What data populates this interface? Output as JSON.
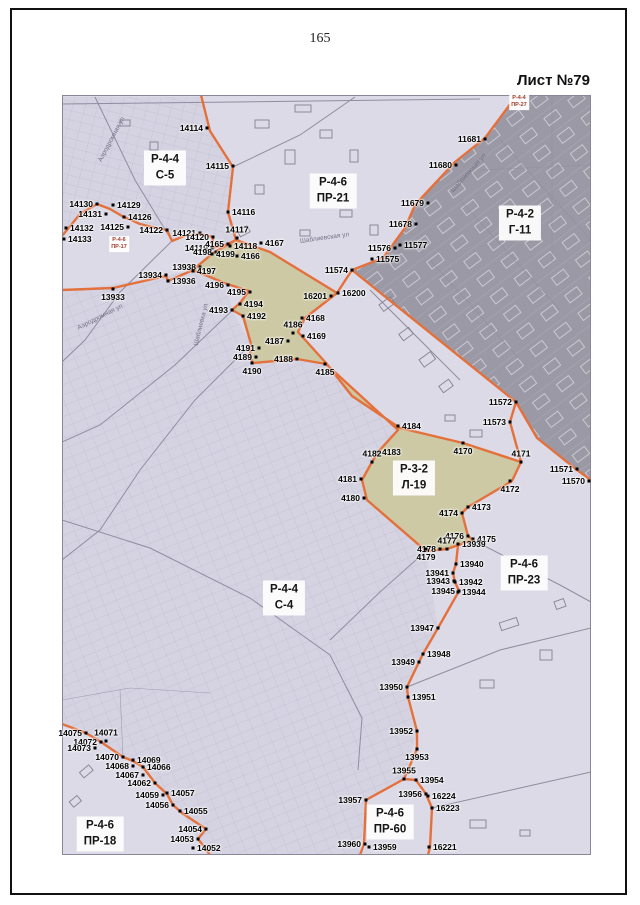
{
  "page": {
    "number": "165",
    "sheet_label": "Лист №79"
  },
  "colors": {
    "boundary": "#e4703c",
    "map_bg": "#dcdae6",
    "dark_zone": "#9b99a5",
    "khaki_zone": "#cdc9a4",
    "street": "#8f8da0"
  },
  "map": {
    "zones": [
      {
        "code": "Р-4-4",
        "name": "С-5",
        "x": 165,
        "y": 168
      },
      {
        "code": "Р-4-6",
        "name": "ПР-21",
        "x": 333,
        "y": 191
      },
      {
        "code": "Р-4-2",
        "name": "Г-11",
        "x": 520,
        "y": 223
      },
      {
        "code": "Р-3-2",
        "name": "Л-19",
        "x": 414,
        "y": 478
      },
      {
        "code": "Р-4-4",
        "name": "С-4",
        "x": 284,
        "y": 598
      },
      {
        "code": "Р-4-6",
        "name": "ПР-23",
        "x": 524,
        "y": 573
      },
      {
        "code": "Р-4-6",
        "name": "ПР-18",
        "x": 100,
        "y": 834
      },
      {
        "code": "Р-4-6",
        "name": "ПР-60",
        "x": 390,
        "y": 822
      }
    ],
    "mini_zones": [
      {
        "code": "Р-4-6",
        "name": "ПР-17",
        "x": 119,
        "y": 244
      },
      {
        "code": "Р-4-4",
        "name": "ПР-27",
        "x": 519,
        "y": 102
      }
    ],
    "street_names": [
      {
        "label": "Аэродромная ул",
        "x": 100,
        "y": 158,
        "rot": -62
      },
      {
        "label": "Аэродромная ул",
        "x": 78,
        "y": 325,
        "rot": -27
      },
      {
        "label": "Шаблиевская ул",
        "x": 300,
        "y": 238,
        "rot": -8
      },
      {
        "label": "Шаблиевская ул",
        "x": 452,
        "y": 188,
        "rot": -48
      },
      {
        "label": "Шаблиевка ул",
        "x": 196,
        "y": 342,
        "rot": -76
      }
    ],
    "points": [
      {
        "label": "14114",
        "x": 207,
        "y": 128,
        "side": "l"
      },
      {
        "label": "14115",
        "x": 233,
        "y": 166,
        "side": "l"
      },
      {
        "label": "14116",
        "x": 228,
        "y": 212,
        "side": "r"
      },
      {
        "label": "14130",
        "x": 97,
        "y": 204,
        "side": "l"
      },
      {
        "label": "14129",
        "x": 113,
        "y": 205,
        "side": "r"
      },
      {
        "label": "14131",
        "x": 106,
        "y": 214,
        "side": "l"
      },
      {
        "label": "14126",
        "x": 124,
        "y": 217,
        "side": "r"
      },
      {
        "label": "14132",
        "x": 66,
        "y": 228,
        "side": "r"
      },
      {
        "label": "14133",
        "x": 64,
        "y": 239,
        "side": "r"
      },
      {
        "label": "14125",
        "x": 128,
        "y": 227,
        "side": "l"
      },
      {
        "label": "14122",
        "x": 167,
        "y": 230,
        "side": "l"
      },
      {
        "label": "14121",
        "x": 200,
        "y": 233,
        "side": "l"
      },
      {
        "label": "14120",
        "x": 213,
        "y": 237,
        "side": "l"
      },
      {
        "label": "14119",
        "x": 212,
        "y": 248,
        "side": "l"
      },
      {
        "label": "4165",
        "x": 228,
        "y": 244,
        "side": "l"
      },
      {
        "label": "14117",
        "x": 237,
        "y": 238,
        "side": "t"
      },
      {
        "label": "14118",
        "x": 230,
        "y": 246,
        "side": "r"
      },
      {
        "label": "4167",
        "x": 261,
        "y": 243,
        "side": "r"
      },
      {
        "label": "4198",
        "x": 216,
        "y": 252,
        "side": "l"
      },
      {
        "label": "4199",
        "x": 212,
        "y": 254,
        "side": "r"
      },
      {
        "label": "4166",
        "x": 237,
        "y": 256,
        "side": "r"
      },
      {
        "label": "13938",
        "x": 200,
        "y": 267,
        "side": "l"
      },
      {
        "label": "4197",
        "x": 193,
        "y": 271,
        "side": "r"
      },
      {
        "label": "13934",
        "x": 166,
        "y": 275,
        "side": "l"
      },
      {
        "label": "13936",
        "x": 168,
        "y": 281,
        "side": "r"
      },
      {
        "label": "4196",
        "x": 228,
        "y": 285,
        "side": "l"
      },
      {
        "label": "4195",
        "x": 250,
        "y": 292,
        "side": "l"
      },
      {
        "label": "13933",
        "x": 113,
        "y": 289,
        "side": "b"
      },
      {
        "label": "4194",
        "x": 240,
        "y": 304,
        "side": "r"
      },
      {
        "label": "4193",
        "x": 232,
        "y": 310,
        "side": "l"
      },
      {
        "label": "4192",
        "x": 243,
        "y": 316,
        "side": "r"
      },
      {
        "label": "16201",
        "x": 331,
        "y": 296,
        "side": "l"
      },
      {
        "label": "16200",
        "x": 338,
        "y": 293,
        "side": "r"
      },
      {
        "label": "4168",
        "x": 302,
        "y": 318,
        "side": "r"
      },
      {
        "label": "4169",
        "x": 303,
        "y": 336,
        "side": "r"
      },
      {
        "label": "4186",
        "x": 293,
        "y": 333,
        "side": "t"
      },
      {
        "label": "4187",
        "x": 288,
        "y": 341,
        "side": "l"
      },
      {
        "label": "4191",
        "x": 259,
        "y": 348,
        "side": "l"
      },
      {
        "label": "4189",
        "x": 256,
        "y": 357,
        "side": "l"
      },
      {
        "label": "4190",
        "x": 252,
        "y": 363,
        "side": "b"
      },
      {
        "label": "4188",
        "x": 297,
        "y": 359,
        "side": "l"
      },
      {
        "label": "4185",
        "x": 325,
        "y": 364,
        "side": "b"
      },
      {
        "label": "11681",
        "x": 485,
        "y": 139,
        "side": "l"
      },
      {
        "label": "11680",
        "x": 456,
        "y": 165,
        "side": "l"
      },
      {
        "label": "11679",
        "x": 428,
        "y": 203,
        "side": "l"
      },
      {
        "label": "11678",
        "x": 416,
        "y": 224,
        "side": "l"
      },
      {
        "label": "11576",
        "x": 395,
        "y": 248,
        "side": "l"
      },
      {
        "label": "11577",
        "x": 400,
        "y": 245,
        "side": "r"
      },
      {
        "label": "11575",
        "x": 372,
        "y": 259,
        "side": "r"
      },
      {
        "label": "11574",
        "x": 352,
        "y": 270,
        "side": "l"
      },
      {
        "label": "11572",
        "x": 516,
        "y": 402,
        "side": "l"
      },
      {
        "label": "11573",
        "x": 510,
        "y": 422,
        "side": "l"
      },
      {
        "label": "4184",
        "x": 398,
        "y": 426,
        "side": "r"
      },
      {
        "label": "4183",
        "x": 378,
        "y": 452,
        "side": "r"
      },
      {
        "label": "4182",
        "x": 372,
        "y": 462,
        "side": "t"
      },
      {
        "label": "4170",
        "x": 463,
        "y": 443,
        "side": "b"
      },
      {
        "label": "4171",
        "x": 521,
        "y": 462,
        "side": "t"
      },
      {
        "label": "11571",
        "x": 577,
        "y": 469,
        "side": "l"
      },
      {
        "label": "11570",
        "x": 589,
        "y": 481,
        "side": "l"
      },
      {
        "label": "4172",
        "x": 510,
        "y": 481,
        "side": "b"
      },
      {
        "label": "4181",
        "x": 361,
        "y": 479,
        "side": "l"
      },
      {
        "label": "4180",
        "x": 364,
        "y": 498,
        "side": "l"
      },
      {
        "label": "4174",
        "x": 462,
        "y": 513,
        "side": "l"
      },
      {
        "label": "4173",
        "x": 468,
        "y": 507,
        "side": "r"
      },
      {
        "label": "4176",
        "x": 468,
        "y": 536,
        "side": "l"
      },
      {
        "label": "4175",
        "x": 473,
        "y": 539,
        "side": "r"
      },
      {
        "label": "4178",
        "x": 440,
        "y": 549,
        "side": "l"
      },
      {
        "label": "4177",
        "x": 447,
        "y": 549,
        "side": "t"
      },
      {
        "label": "13939",
        "x": 458,
        "y": 544,
        "side": "r"
      },
      {
        "label": "4179",
        "x": 426,
        "y": 549,
        "side": "b"
      },
      {
        "label": "13940",
        "x": 456,
        "y": 564,
        "side": "r"
      },
      {
        "label": "13941",
        "x": 453,
        "y": 573,
        "side": "l"
      },
      {
        "label": "13943",
        "x": 454,
        "y": 581,
        "side": "l"
      },
      {
        "label": "13942",
        "x": 455,
        "y": 582,
        "side": "r"
      },
      {
        "label": "13945",
        "x": 459,
        "y": 591,
        "side": "l"
      },
      {
        "label": "13944",
        "x": 458,
        "y": 592,
        "side": "r"
      },
      {
        "label": "13947",
        "x": 438,
        "y": 628,
        "side": "l"
      },
      {
        "label": "13948",
        "x": 423,
        "y": 654,
        "side": "r"
      },
      {
        "label": "13949",
        "x": 419,
        "y": 662,
        "side": "l"
      },
      {
        "label": "13950",
        "x": 407,
        "y": 687,
        "side": "l"
      },
      {
        "label": "13951",
        "x": 408,
        "y": 697,
        "side": "r"
      },
      {
        "label": "13952",
        "x": 417,
        "y": 731,
        "side": "l"
      },
      {
        "label": "13953",
        "x": 417,
        "y": 749,
        "side": "b"
      },
      {
        "label": "13955",
        "x": 404,
        "y": 779,
        "side": "t"
      },
      {
        "label": "13954",
        "x": 416,
        "y": 780,
        "side": "r"
      },
      {
        "label": "13956",
        "x": 426,
        "y": 794,
        "side": "l"
      },
      {
        "label": "16224",
        "x": 428,
        "y": 796,
        "side": "r"
      },
      {
        "label": "16223",
        "x": 432,
        "y": 808,
        "side": "r"
      },
      {
        "label": "13957",
        "x": 366,
        "y": 800,
        "side": "l"
      },
      {
        "label": "13960",
        "x": 365,
        "y": 844,
        "side": "l"
      },
      {
        "label": "13959",
        "x": 369,
        "y": 847,
        "side": "r"
      },
      {
        "label": "16221",
        "x": 429,
        "y": 847,
        "side": "r"
      },
      {
        "label": "14075",
        "x": 86,
        "y": 733,
        "side": "l"
      },
      {
        "label": "14072",
        "x": 101,
        "y": 742,
        "side": "l"
      },
      {
        "label": "14071",
        "x": 106,
        "y": 741,
        "side": "t"
      },
      {
        "label": "14073",
        "x": 95,
        "y": 748,
        "side": "l"
      },
      {
        "label": "14070",
        "x": 123,
        "y": 757,
        "side": "l"
      },
      {
        "label": "14069",
        "x": 133,
        "y": 760,
        "side": "r"
      },
      {
        "label": "14068",
        "x": 133,
        "y": 766,
        "side": "l"
      },
      {
        "label": "14066",
        "x": 143,
        "y": 767,
        "side": "r"
      },
      {
        "label": "14067",
        "x": 143,
        "y": 775,
        "side": "l"
      },
      {
        "label": "14062",
        "x": 155,
        "y": 783,
        "side": "l"
      },
      {
        "label": "14059",
        "x": 163,
        "y": 795,
        "side": "l"
      },
      {
        "label": "14057",
        "x": 167,
        "y": 793,
        "side": "r"
      },
      {
        "label": "14056",
        "x": 173,
        "y": 805,
        "side": "l"
      },
      {
        "label": "14055",
        "x": 180,
        "y": 811,
        "side": "r"
      },
      {
        "label": "14054",
        "x": 206,
        "y": 829,
        "side": "l"
      },
      {
        "label": "14053",
        "x": 198,
        "y": 839,
        "side": "l"
      },
      {
        "label": "14052",
        "x": 193,
        "y": 848,
        "side": "r"
      }
    ]
  }
}
